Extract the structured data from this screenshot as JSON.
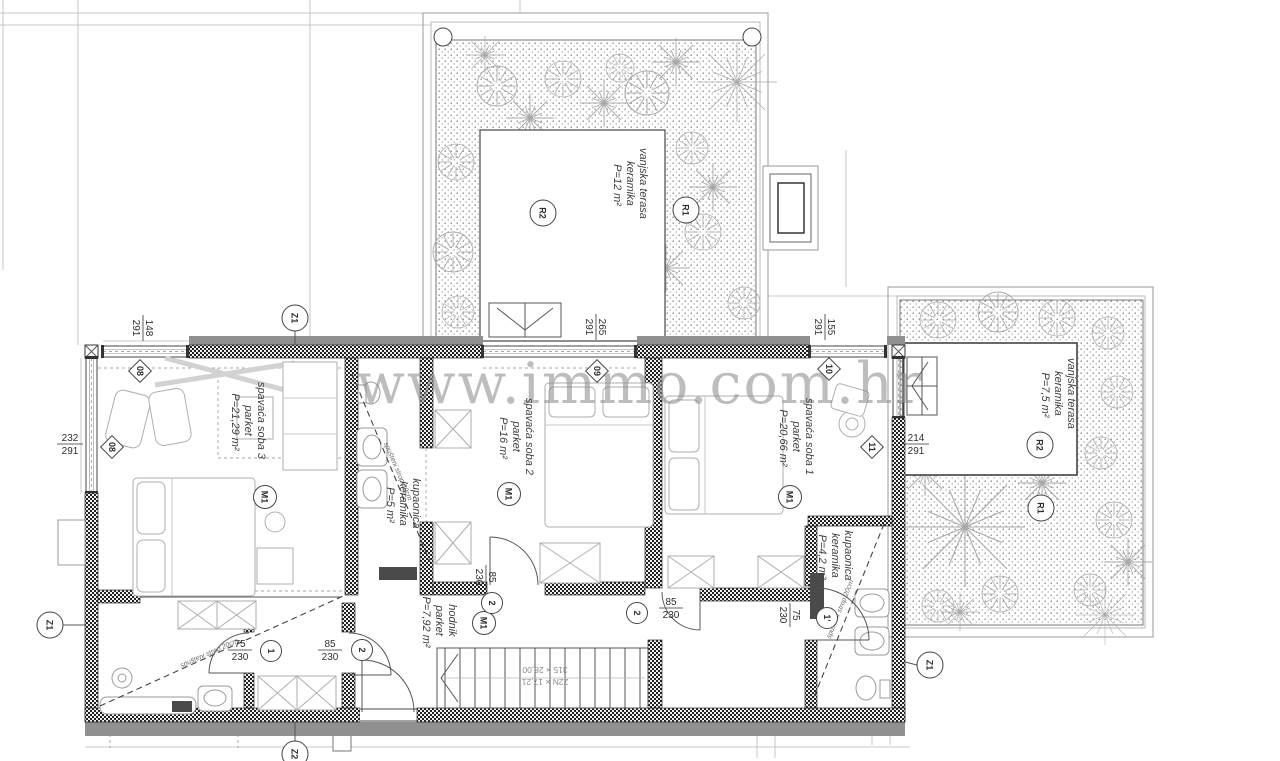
{
  "watermark": "www.immo.com.hr",
  "rooms": [
    {
      "id": "spavaca-soba-3",
      "label": "spavaća soba 3",
      "floor": "parket",
      "area": "P=21,29 m²"
    },
    {
      "id": "kupaonica-2",
      "label": "kupaonica",
      "floor": "keramika",
      "area": "P=5 m²"
    },
    {
      "id": "spavaca-soba-2",
      "label": "spavaća soba 2",
      "floor": "parket",
      "area": "P=16 m²"
    },
    {
      "id": "spavaca-soba-1",
      "label": "spavaća soba 1",
      "floor": "parket",
      "area": "P=20,66 m²"
    },
    {
      "id": "kupaonica-1",
      "label": "kupaonica",
      "floor": "keramika",
      "area": "P=4,2 m²"
    },
    {
      "id": "hodnik",
      "label": "hodnik",
      "floor": "parket",
      "area": "P=7,92 m²"
    },
    {
      "id": "vanjska-terasa-gornja",
      "label": "vanjska terasa",
      "floor": "keramika",
      "area": "P=12 m²"
    },
    {
      "id": "vanjska-terasa-desna",
      "label": "vanjska terasa",
      "floor": "keramika",
      "area": "P=7,5 m²"
    }
  ],
  "markers": {
    "z1": "Z1",
    "z2": "Z2",
    "m1": "M1",
    "r1": "R1",
    "r2": "R2",
    "w08": "08",
    "w09": "09",
    "w10": "10",
    "w11": "11",
    "d1": "1",
    "d2": "2",
    "d1p": "1'"
  },
  "dimensions": {
    "win08": {
      "w": "148",
      "h": "291"
    },
    "win08b": {
      "w": "232",
      "h": "291"
    },
    "win09": {
      "w": "265",
      "h": "291"
    },
    "win10": {
      "w": "155",
      "h": "291"
    },
    "win11": {
      "w": "214",
      "h": "291"
    },
    "door85": {
      "w": "85",
      "h": "230"
    },
    "door75": {
      "w": "75",
      "h": "230"
    }
  },
  "stairs": {
    "line1": "22N × 17,21",
    "line2": "315 × 28,00"
  },
  "notes": {
    "ceiling": "spušteni strop 20cm"
  }
}
